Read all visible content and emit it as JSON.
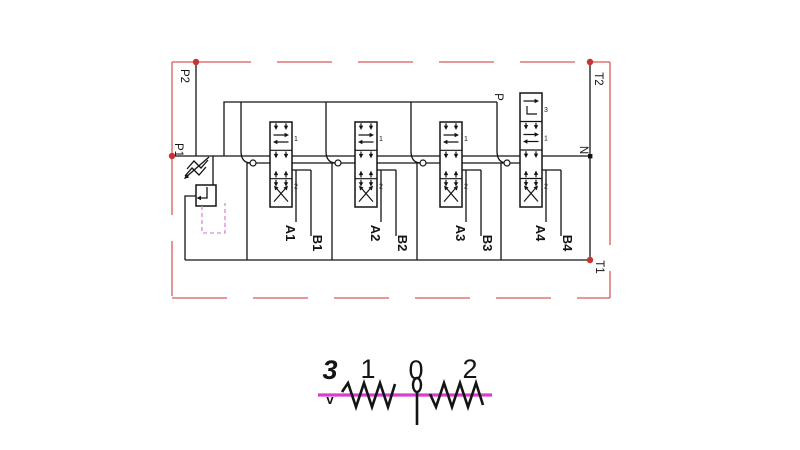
{
  "diagram": {
    "port_labels": {
      "p2": "P2",
      "p1": "P1",
      "t2": "T2",
      "t1": "T1",
      "n": "N",
      "p": "P"
    },
    "work_port_labels": [
      "A1",
      "B1",
      "A2",
      "B2",
      "A3",
      "B3",
      "A4",
      "B4"
    ],
    "valves": [
      {
        "name": "section-1",
        "spool": [
          "parallel-arrows",
          "closed-center",
          "crossed-arrows"
        ],
        "position_labels": [
          "1",
          "2"
        ]
      },
      {
        "name": "section-2",
        "spool": [
          "parallel-arrows",
          "closed-center",
          "crossed-arrows"
        ],
        "position_labels": [
          "1",
          "2"
        ]
      },
      {
        "name": "section-3",
        "spool": [
          "parallel-arrows",
          "closed-center",
          "crossed-arrows"
        ],
        "position_labels": [
          "1",
          "2"
        ]
      },
      {
        "name": "section-4",
        "spool": [
          "float",
          "parallel-arrows",
          "closed-center",
          "crossed-arrows"
        ],
        "position_labels": [
          "3",
          "1",
          "2"
        ]
      }
    ],
    "selector": {
      "position_numbers": [
        "3",
        "1",
        "0",
        "2"
      ],
      "check_mark": "v"
    },
    "colors": {
      "line": "#141414",
      "border_red": "#d95b5b",
      "port_dot_red": "#c63333",
      "magenta": "#da3ecf",
      "pilot_magenta": "#d98ad9"
    }
  }
}
